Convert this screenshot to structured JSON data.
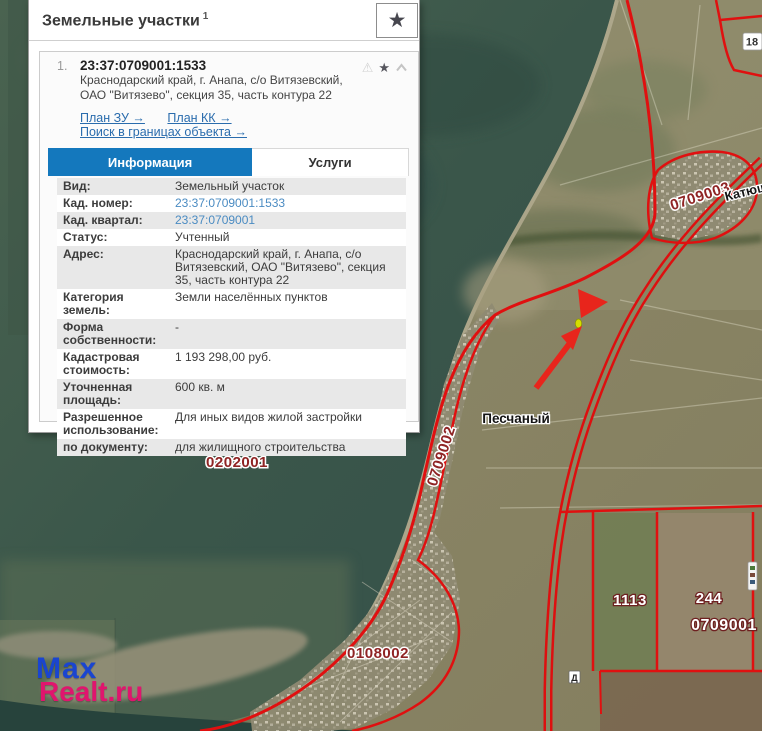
{
  "panel": {
    "title": "Земельные участки",
    "title_sup": "1",
    "result": {
      "index": "1.",
      "cadastral_number": "23:37:0709001:1533",
      "address_line1": "Краснодарский край, г. Анапа, с/о Витязевский,",
      "address_line2": "ОАО \"Витязево\", секция 35, часть контура 22",
      "links": {
        "plan_zu": "План ЗУ →",
        "plan_kk": "План КК →",
        "search_in_bounds": "Поиск в границах объекта →"
      }
    },
    "tabs": [
      {
        "label": "Информация",
        "active": true
      },
      {
        "label": "Услуги",
        "active": false
      }
    ],
    "info_rows": [
      {
        "label": "Вид:",
        "value": "Земельный участок"
      },
      {
        "label": "Кад. номер:",
        "value": "23:37:0709001:1533"
      },
      {
        "label": "Кад. квартал:",
        "value": "23:37:0709001"
      },
      {
        "label": "Статус:",
        "value": "Учтенный"
      },
      {
        "label": "Адрес:",
        "value": "Краснодарский край, г. Анапа, с/о Витязевский, ОАО \"Витязево\", секция 35, часть контура 22"
      },
      {
        "label": "Категория земель:",
        "value": "Земли населённых пунктов"
      },
      {
        "label": "Форма собственности:",
        "value": "-"
      },
      {
        "label": "Кадастровая стоимость:",
        "value": "1 193 298,00 руб."
      },
      {
        "label": "Уточненная площадь:",
        "value": "600 кв. м"
      },
      {
        "label": "Разрешенное использование:",
        "value": "Для иных видов жилой застройки"
      },
      {
        "label": "по документу:",
        "value": "для жилищного строительства"
      }
    ]
  },
  "map": {
    "labels": {
      "quarter_0202001": "0202001",
      "quarter_0709002": "0709002",
      "quarter_0709003": "0709003",
      "quarter_0108002": "0108002",
      "quarter_0709001": "0709001",
      "parcel_1113": "1113",
      "parcel_244": "244",
      "parcel_18": "18",
      "settlement_peschany": "Песчаный",
      "settlement_katyusha": "Катюша",
      "marker_d": "Д"
    },
    "colors": {
      "boundary_red": "#e01010",
      "water_teal": "#3d584a",
      "land_olive": "#898766",
      "selected_parcel_yellow": "#d4de00",
      "active_tab_blue": "#1478bd",
      "link_blue": "#2a6cad",
      "quarter_label_maroon": "#8f2424"
    }
  },
  "watermark": {
    "line1": "Max",
    "line2": "Realt.ru"
  }
}
